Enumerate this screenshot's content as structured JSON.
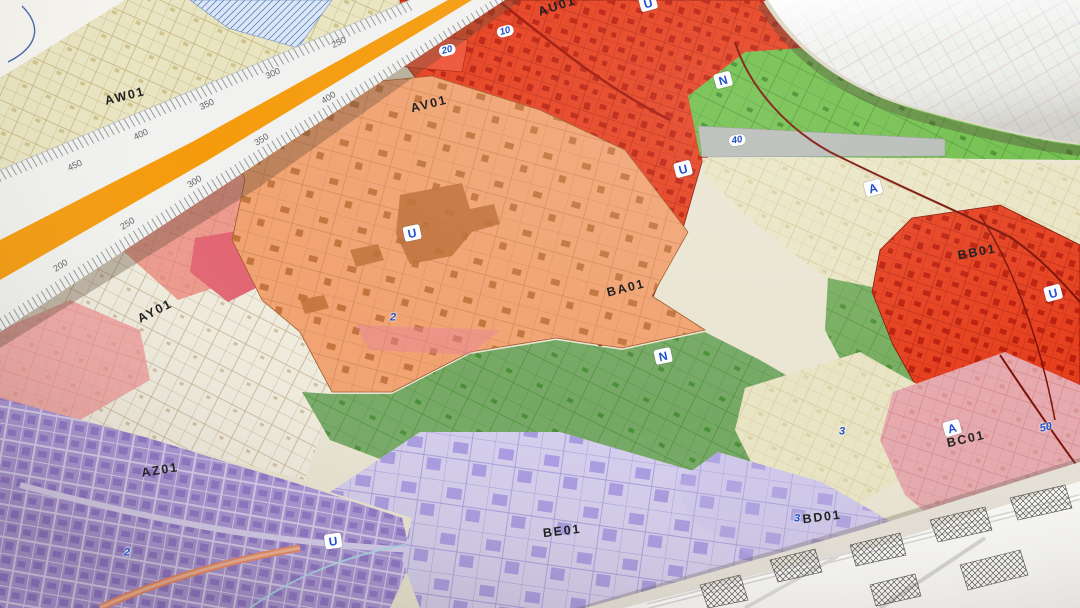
{
  "sectors": {
    "aw01": "AW01",
    "au01": "AU01",
    "av01": "AV01",
    "ay01": "AY01",
    "az01": "AZ01",
    "ba01": "BA01",
    "bb01": "BB01",
    "bc01": "BC01",
    "bd01": "BD01",
    "be01": "BE01"
  },
  "markers": {
    "u": "U",
    "n": "N",
    "a": "A"
  },
  "parcels": {
    "p2": "2",
    "p3": "3",
    "p10": "10",
    "p20": "20",
    "p40": "40",
    "p50": "50"
  },
  "ruler": {
    "upper": [
      "250",
      "300",
      "350",
      "400",
      "450"
    ],
    "lower": [
      "200",
      "250",
      "300",
      "350",
      "400"
    ]
  },
  "colors": {
    "zone_red": "#e63f1d",
    "zone_orange": "#f1a271",
    "zone_green_bright": "#6fbe49",
    "zone_green_muted": "#74a863",
    "zone_beige": "#e9e4c0",
    "zone_ivory": "#efebdd",
    "zone_purple": "#a793d4",
    "zone_lavender": "#d3cdec",
    "zone_pink": "#e5a9ae",
    "zone_salmon": "#ec9a8c",
    "marker_blue": "#1d4fd0",
    "ruler_stripe_orange": "#f59b0c"
  }
}
